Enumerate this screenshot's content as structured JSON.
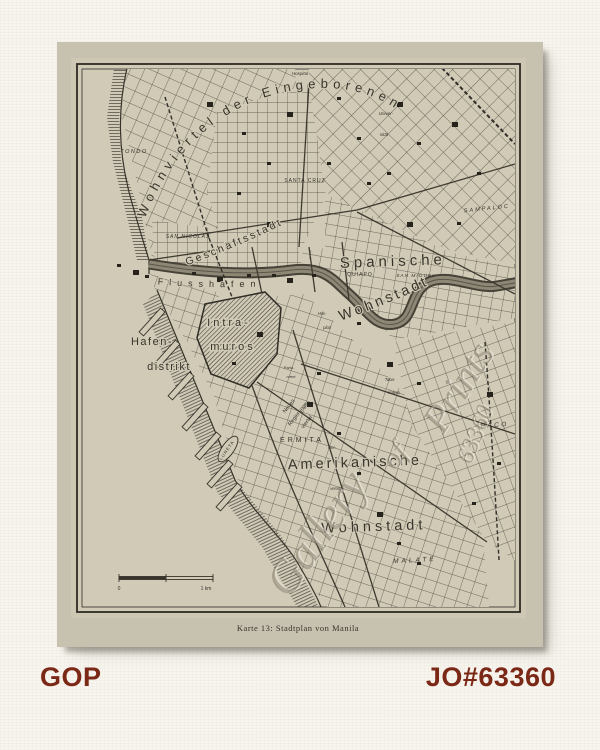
{
  "page": {
    "background": "#f7f5ee",
    "accent_color": "#7b2817",
    "footer_left": "GOP",
    "footer_right": "JO#63360"
  },
  "map": {
    "caption": "Karte 13: Stadtplan von Manila",
    "ink_color": "#38342b",
    "paper_color": "#c7c1af",
    "field_color": "#d0cab7",
    "scale": {
      "left_label": "0",
      "right_label": "1 km"
    },
    "labels": [
      {
        "name": "wohnviertel-der-eingeborenen",
        "text": "Wohnviertel der Eingeborenen",
        "path": "p-wv",
        "size": 13,
        "sp": 5,
        "offset": 6
      },
      {
        "name": "geschaeftsstadt",
        "text": "Geschäftsstadt",
        "path": "p-ge",
        "size": 10.5,
        "sp": 2.5,
        "offset": 2
      },
      {
        "name": "flusshafen",
        "text": "Flusshafen",
        "path": "p-fl",
        "size": 9,
        "sp": 6,
        "offset": 55
      },
      {
        "name": "wohnstadt-spanische",
        "text": "Wohnstadt",
        "path": "p-ws",
        "size": 14.5,
        "sp": 3,
        "offset": 4
      },
      {
        "name": "spanische",
        "text": "Spanische",
        "x": 336,
        "y": 224,
        "size": 15,
        "sp": 4,
        "rot": -2
      },
      {
        "name": "tondo",
        "text": "TONDO",
        "x": 77,
        "y": 111,
        "size": 5.5,
        "sp": 1.5,
        "it": 1
      },
      {
        "name": "hospital",
        "text": "Hospital",
        "x": 243,
        "y": 33,
        "size": 4.5,
        "it": 1
      },
      {
        "name": "universitaet-1",
        "text": "Univer-",
        "x": 329,
        "y": 73,
        "size": 4.5,
        "it": 1
      },
      {
        "name": "universitaet-2",
        "text": "sität",
        "x": 327,
        "y": 94,
        "size": 4.5,
        "it": 1
      },
      {
        "name": "santa-cruz",
        "text": "SANTA CRUZ",
        "x": 248,
        "y": 140,
        "size": 5,
        "sp": 1
      },
      {
        "name": "sampaloc",
        "text": "SAMPALOC",
        "x": 430,
        "y": 168,
        "size": 5.5,
        "sp": 2,
        "it": 1,
        "rot": -6
      },
      {
        "name": "san-nicolas",
        "text": "SAN NICOLAS",
        "x": 131,
        "y": 196,
        "size": 5,
        "sp": 1,
        "it": 1
      },
      {
        "name": "quiapo",
        "text": "QUIAPO",
        "x": 303,
        "y": 234,
        "size": 5,
        "sp": 1
      },
      {
        "name": "san-miguel",
        "text": "SAN MIGUEL",
        "x": 359,
        "y": 235,
        "size": 4.8,
        "sp": 1,
        "it": 1
      },
      {
        "name": "intramuros-1",
        "text": "Intra-",
        "x": 172,
        "y": 284,
        "size": 11,
        "sp": 3,
        "halo": 3
      },
      {
        "name": "intramuros-2",
        "text": "muros",
        "x": 176,
        "y": 308,
        "size": 11,
        "sp": 3,
        "halo": 3
      },
      {
        "name": "hafendistrikt-1",
        "text": "Hafen-",
        "x": 95,
        "y": 303,
        "size": 11,
        "sp": 1.5
      },
      {
        "name": "hafendistrikt-2",
        "text": "distrikt",
        "x": 112,
        "y": 328,
        "size": 11,
        "sp": 1.5
      },
      {
        "name": "hospital2-1",
        "text": "Hos-",
        "x": 265,
        "y": 273,
        "size": 4.2,
        "it": 1
      },
      {
        "name": "hospital2-2",
        "text": "pital",
        "x": 270,
        "y": 287,
        "size": 4.2,
        "it": 1
      },
      {
        "name": "parlament-1",
        "text": "Parla-",
        "x": 232,
        "y": 327,
        "size": 4,
        "it": 1
      },
      {
        "name": "parlament-2",
        "text": "ment",
        "x": 234,
        "y": 336,
        "size": 4,
        "it": 1
      },
      {
        "name": "tabakalera-1",
        "text": "Taba-",
        "x": 333,
        "y": 339,
        "size": 4.2,
        "it": 1
      },
      {
        "name": "tabakalera-2",
        "text": "kalera",
        "x": 337,
        "y": 352,
        "size": 4.2,
        "it": 1
      },
      {
        "name": "paco",
        "text": "PACO",
        "x": 438,
        "y": 385,
        "size": 6.5,
        "sp": 2.5,
        "it": 1,
        "rot": -4
      },
      {
        "name": "neues-regierungsviertel-1",
        "text": "Neues",
        "x": 233,
        "y": 365,
        "size": 5.5,
        "rot": -52
      },
      {
        "name": "neues-regierungsviertel-2",
        "text": "Regierungs",
        "x": 242,
        "y": 373,
        "size": 5.5,
        "rot": -52
      },
      {
        "name": "neues-regierungsviertel-3",
        "text": "viertel",
        "x": 251,
        "y": 381,
        "size": 5.5,
        "rot": -52
      },
      {
        "name": "luneta",
        "text": "LUNETA",
        "x": 171,
        "y": 409,
        "size": 4.3,
        "sp": 1,
        "rot": -55
      },
      {
        "name": "ermita",
        "text": "ERMITA",
        "x": 245,
        "y": 400,
        "size": 7,
        "sp": 3
      },
      {
        "name": "universitaet2-1",
        "text": "Uni-",
        "x": 275,
        "y": 407,
        "size": 4.2,
        "it": 1
      },
      {
        "name": "universitaet2-2",
        "text": "versität",
        "x": 280,
        "y": 448,
        "size": 4.2,
        "it": 1
      },
      {
        "name": "amerikanische",
        "text": "Amerikanische",
        "x": 298,
        "y": 425,
        "size": 14.5,
        "sp": 3,
        "rot": -2
      },
      {
        "name": "wohnstadt-amerikanische",
        "text": "Wohnstadt",
        "x": 317,
        "y": 489,
        "size": 14.5,
        "sp": 4,
        "rot": -2
      },
      {
        "name": "malate",
        "text": "MALATE",
        "x": 358,
        "y": 520,
        "size": 6.5,
        "sp": 3,
        "it": 1,
        "rot": -3
      },
      {
        "name": "scale-zero",
        "text": "0",
        "x": 62,
        "y": 548,
        "size": 5
      },
      {
        "name": "scale-one-km",
        "text": "1 km",
        "x": 149,
        "y": 548,
        "size": 5
      },
      {
        "name": "map-caption",
        "text": "Karte 13: Stadtplan von Manila",
        "x": 241,
        "y": 589,
        "size": 8.5,
        "serif": 1,
        "sp": 0.5
      }
    ],
    "watermark": [
      {
        "name": "watermark-gallery",
        "text": "Gallery",
        "x": 272,
        "y": 500,
        "rot": -55,
        "size": 46
      },
      {
        "name": "watermark-of",
        "text": "of",
        "x": 345,
        "y": 420,
        "rot": -52,
        "size": 30
      },
      {
        "name": "watermark-prints",
        "text": "Prints",
        "x": 412,
        "y": 352,
        "rot": -58,
        "size": 40
      },
      {
        "name": "watermark-number",
        "text": "63360",
        "x": 425,
        "y": 395,
        "rot": -68,
        "size": 24
      }
    ]
  }
}
